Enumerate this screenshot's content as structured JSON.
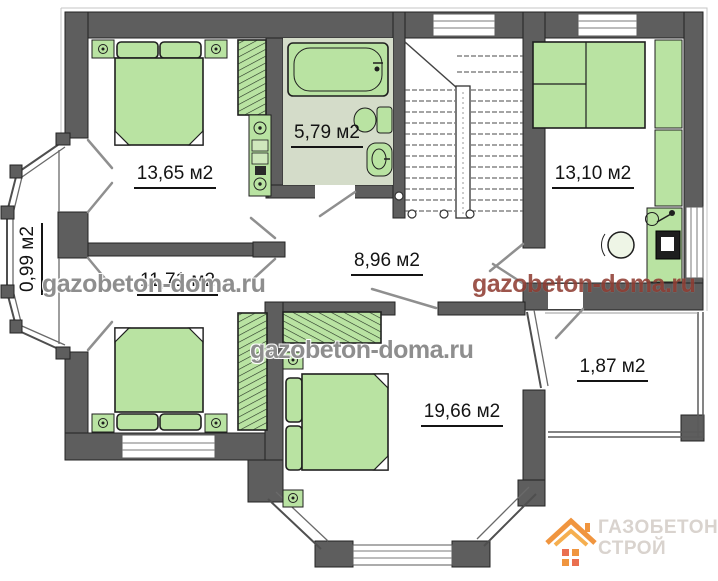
{
  "plan": {
    "room_labels": [
      {
        "id": "bedroom-top-left",
        "text": "13,65 м2"
      },
      {
        "id": "bathroom",
        "text": "5,79 м2"
      },
      {
        "id": "room-right",
        "text": "13,10 м2"
      },
      {
        "id": "bay-window-left",
        "text": "0,99 м2"
      },
      {
        "id": "bedroom-mid-left",
        "text": "11,71 м2"
      },
      {
        "id": "hallway",
        "text": "8,96 м2"
      },
      {
        "id": "bedroom-bottom",
        "text": "19,66 м2"
      },
      {
        "id": "balcony-right",
        "text": "1,87 м2"
      }
    ],
    "watermarks": {
      "left": "gazobeton-doma.ru",
      "center": "gazobeton-doma.ru",
      "right": "gazobeton-doma.ru"
    },
    "logo": {
      "line1": "ГАЗОБЕТОН",
      "line2": "СТРОЙ"
    },
    "colors": {
      "wall": "#5e5e5e",
      "furniture_green": "#b9e3a2",
      "bathroom_floor": "#d4dcc9",
      "watermark_gray": "#7a7a7a",
      "watermark_red": "#883024",
      "logo_orange": "#ef8a2b"
    }
  }
}
